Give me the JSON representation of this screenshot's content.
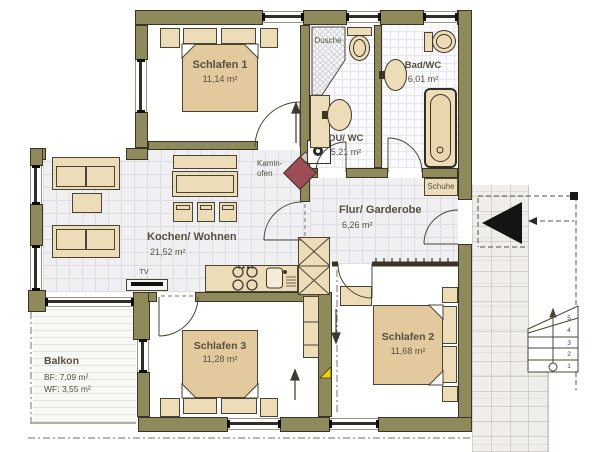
{
  "plan": {
    "rooms": {
      "schlafen1": {
        "name": "Schlafen 1",
        "area": "11,14 m²"
      },
      "du_wc": {
        "name": "DU/ WC",
        "area": "5,21 m²"
      },
      "bad_wc": {
        "name": "Bad/WC",
        "area": "6,01 m²"
      },
      "kochen_wohnen": {
        "name": "Kochen/ Wohnen",
        "area": "21,52 m²"
      },
      "flur_garderobe": {
        "name": "Flur/ Garderobe",
        "area": "6,26 m²"
      },
      "schlafen2": {
        "name": "Schlafen 2",
        "area": "11,68 m²"
      },
      "schlafen3": {
        "name": "Schlafen 3",
        "area": "11,28 m²"
      },
      "balkon": {
        "name": "Balkon",
        "bf": "BF: 7,09 m²",
        "wf": "WF: 3,55 m²"
      }
    },
    "fixtures": {
      "dusche": "Dusche",
      "schuhe": "Schuhe",
      "tv": "TV",
      "kaminofen": [
        "Kamin-",
        "ofen"
      ]
    },
    "stairs": {
      "steps": [
        "1",
        "2",
        "3",
        "4",
        "5"
      ]
    },
    "colors": {
      "wall": "#8f8a5c",
      "furniture": "#ecdcb8",
      "stove": "#9c4d55",
      "marker": "#f2d200"
    }
  }
}
